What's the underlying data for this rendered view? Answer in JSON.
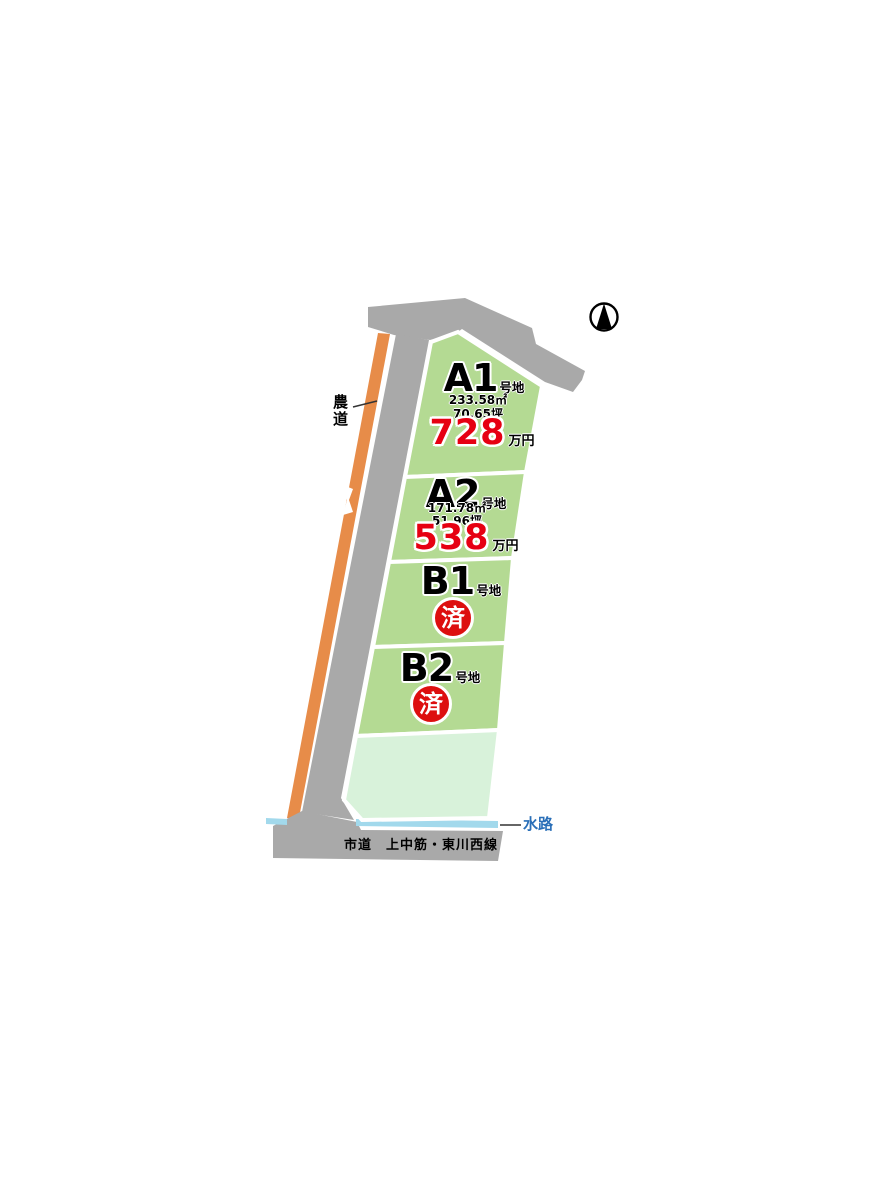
{
  "map": {
    "compass": {
      "icon": "north-arrow"
    },
    "roads": {
      "farm_road_label": "農道",
      "city_road_label": "市道　上中筋・東川西線",
      "waterway_label": "水路"
    },
    "plots": [
      {
        "id": "A1",
        "label": "A1",
        "suffix": "号地",
        "area_sqm": "233.58㎡",
        "area_tsubo": "70.65坪",
        "price": "728",
        "price_unit": "万円",
        "status": "available"
      },
      {
        "id": "A2",
        "label": "A2",
        "suffix": "号地",
        "area_sqm": "171.78㎡",
        "area_tsubo": "51.96坪",
        "price": "538",
        "price_unit": "万円",
        "status": "available"
      },
      {
        "id": "B1",
        "label": "B1",
        "suffix": "号地",
        "status": "sold",
        "sold_label": "済"
      },
      {
        "id": "B2",
        "label": "B2",
        "suffix": "号地",
        "status": "sold",
        "sold_label": "済"
      }
    ],
    "colors": {
      "road_gray": "#a9a9a9",
      "farm_road_orange": "#e78c49",
      "plot_green": "#b4da93",
      "remainder_green": "#d8f2da",
      "water_blue": "#a2d9ec",
      "waterway_text_blue": "#2a6fb8",
      "price_red": "#e60012",
      "sold_red": "#dd0f0f"
    }
  }
}
